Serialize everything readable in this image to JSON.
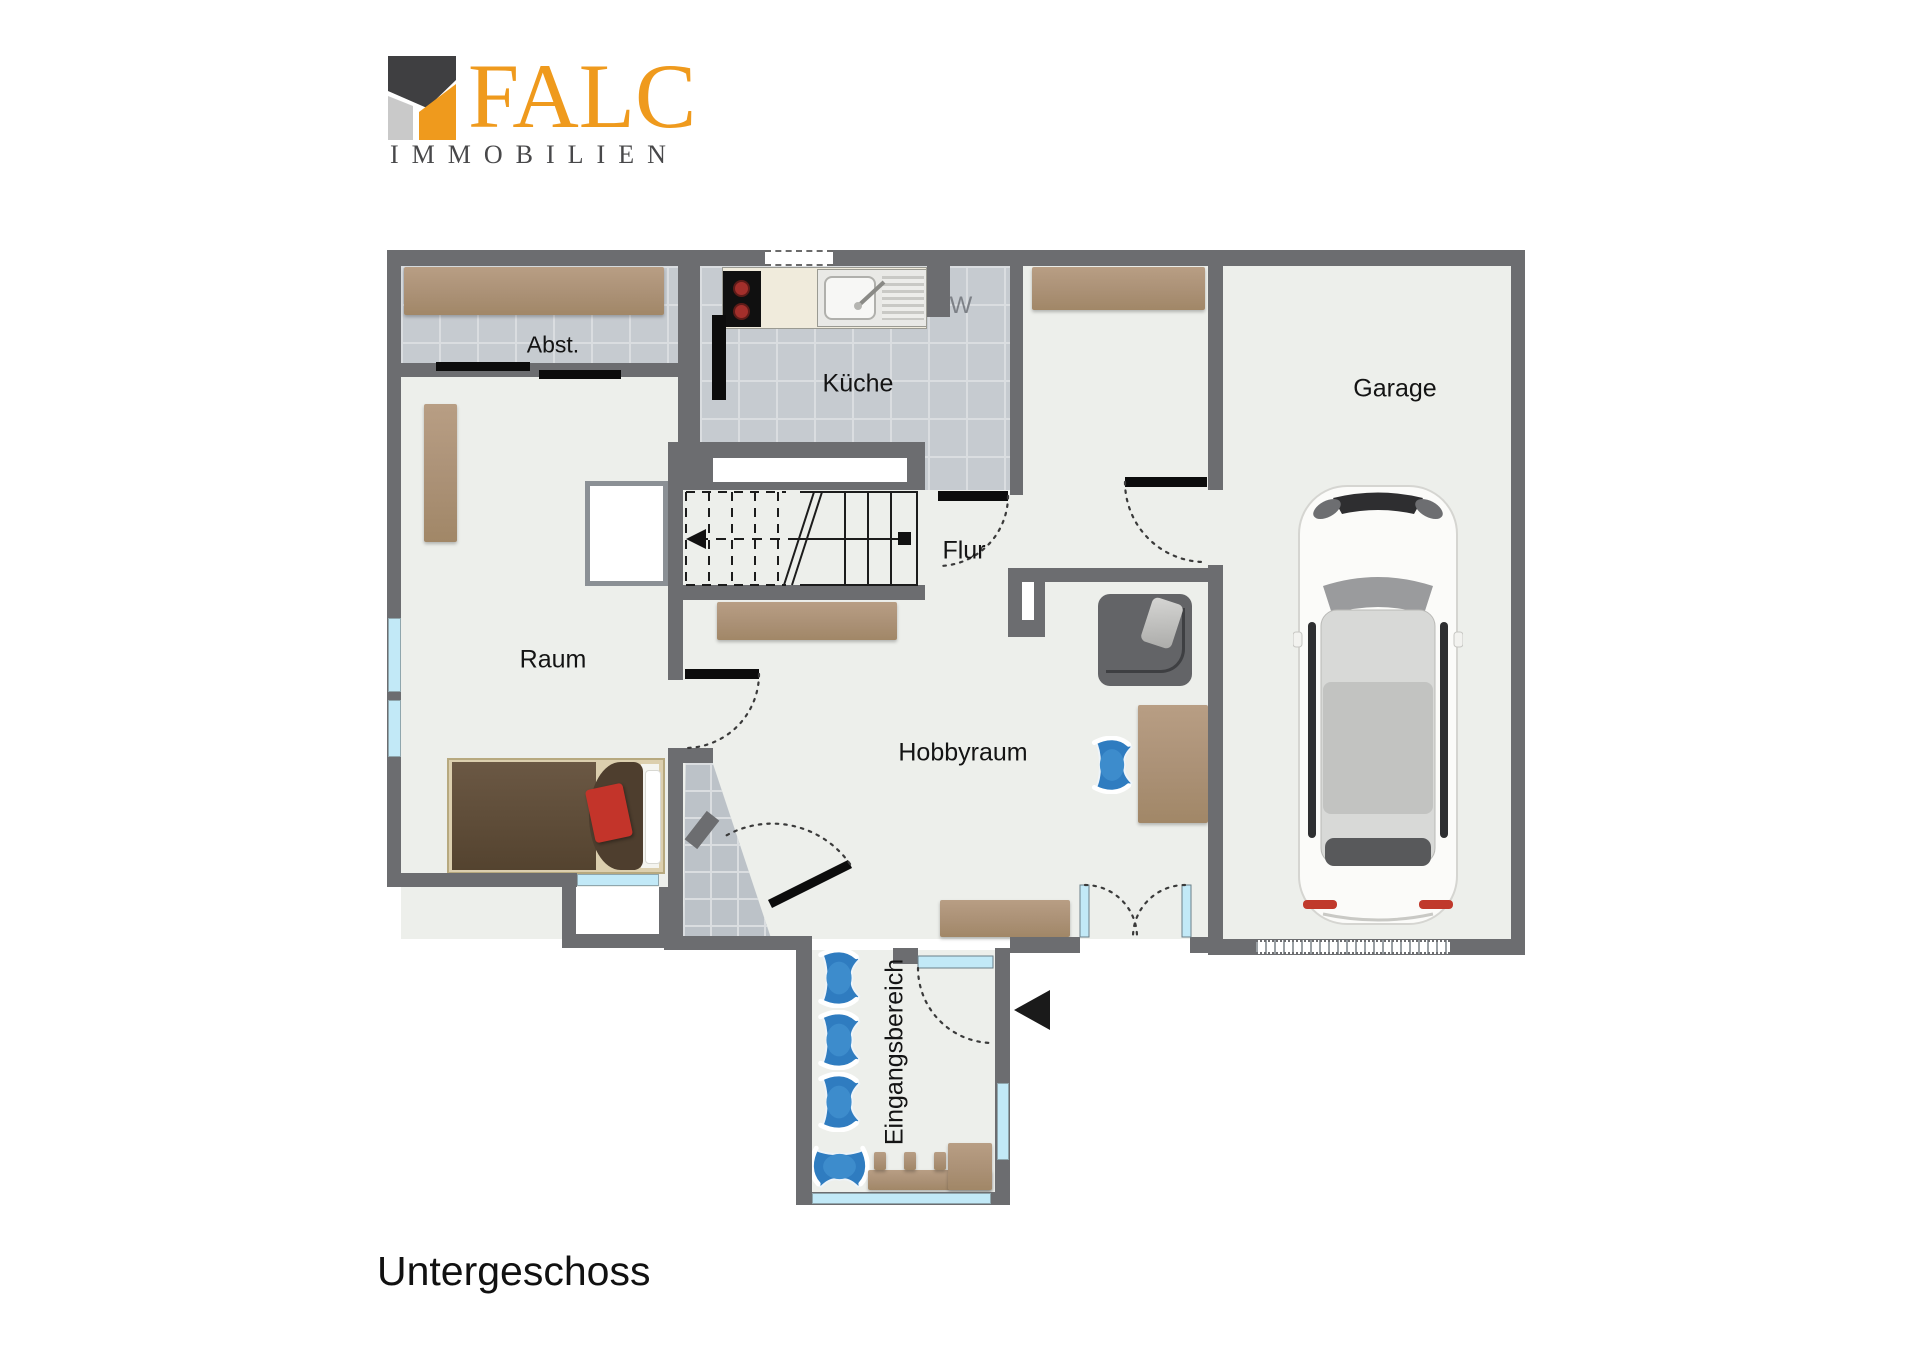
{
  "logo": {
    "name": "FALC",
    "subtitle": "IMMOBILIEN"
  },
  "floor_title": "Untergeschoss",
  "rooms": {
    "abst": "Abst.",
    "kueche": "Küche",
    "garage": "Garage",
    "flur": "Flur",
    "raum": "Raum",
    "hobbyraum": "Hobbyraum",
    "eingangsbereich": "Eingangsbereich"
  },
  "annotations": {
    "washing_machine": "W"
  },
  "colors": {
    "wall": "#6c6d70",
    "floor": "#edefeb",
    "tile": "#c6cbd0",
    "wood": "#b0977c",
    "window_glass": "#c2e9f7",
    "chair_blue": "#2f7cc0",
    "logo_orange": "#ef9a1d",
    "logo_dark": "#3f3f41",
    "logo_gray": "#c9c9c9",
    "bed_red_pillow": "#c3342a"
  }
}
